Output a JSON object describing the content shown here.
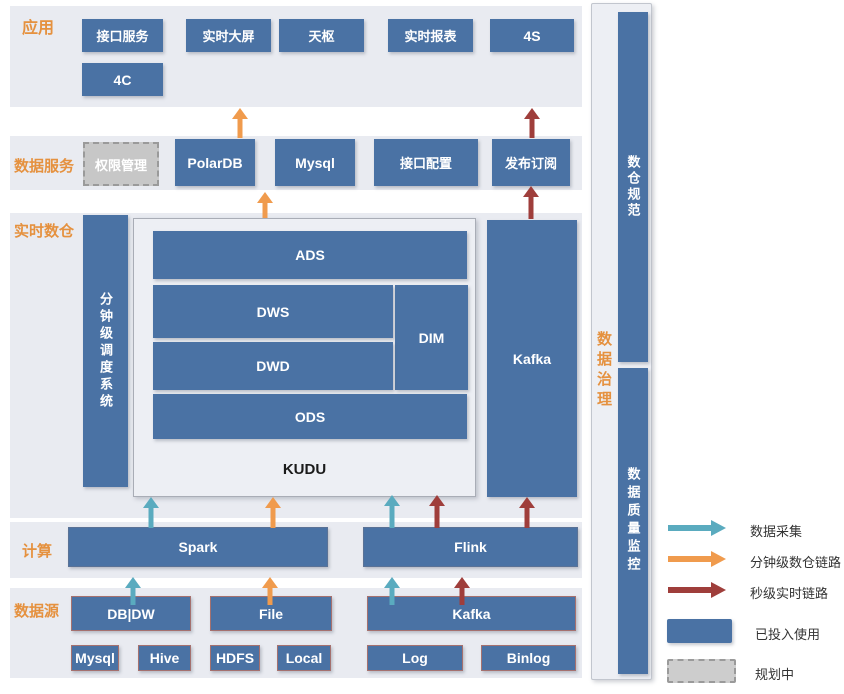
{
  "colors": {
    "box_blue": "#4a72a4",
    "section_bg": "#e9ebf1",
    "section_label_orange": "#e5913f",
    "arrow_teal": "#5aabbf",
    "arrow_orange": "#f09b4d",
    "arrow_red": "#9f3e3b",
    "planned_gray": "#c7c7c7"
  },
  "sections": {
    "app": {
      "label": "应用",
      "boxes": [
        "接口服务",
        "实时大屏",
        "天枢",
        "实时报表",
        "4S",
        "4C"
      ]
    },
    "services": {
      "label": "数据服务",
      "planned_box": "权限管理",
      "boxes": [
        "PolarDB",
        "Mysql",
        "接口配置",
        "发布订阅"
      ]
    },
    "warehouse": {
      "label": "实时数仓",
      "scheduler": "分钟级调度系统",
      "layers": {
        "ads": "ADS",
        "dws": "DWS",
        "dim": "DIM",
        "dwd": "DWD",
        "ods": "ODS"
      },
      "storage": "KUDU",
      "kafka": "Kafka"
    },
    "compute": {
      "label": "计算",
      "boxes": [
        "Spark",
        "Flink"
      ]
    },
    "sources": {
      "label": "数据源",
      "groups": [
        "DB|DW",
        "File",
        "Kafka"
      ],
      "items": [
        "Mysql",
        "Hive",
        "HDFS",
        "Local",
        "Log",
        "Binlog"
      ]
    },
    "governance": {
      "label": "数据治理",
      "boxes": [
        "数仓规范",
        "数据质量监控"
      ]
    }
  },
  "flows": [
    {
      "type": "minute-level",
      "from": "PolarDB",
      "to": "应用"
    },
    {
      "type": "second-level",
      "from": "发布订阅",
      "to": "应用"
    },
    {
      "type": "minute-level",
      "from": "实时数仓",
      "to": "数据服务"
    },
    {
      "type": "second-level",
      "from": "Kafka",
      "to": "发布订阅"
    },
    {
      "type": "collect",
      "from": "Spark",
      "to": "KUDU"
    },
    {
      "type": "minute-level",
      "from": "Spark",
      "to": "KUDU"
    },
    {
      "type": "collect",
      "from": "Flink",
      "to": "KUDU"
    },
    {
      "type": "second-level",
      "from": "Flink",
      "to": "KUDU"
    },
    {
      "type": "second-level",
      "from": "Flink",
      "to": "Kafka"
    },
    {
      "type": "collect",
      "from": "DB|DW",
      "to": "Spark"
    },
    {
      "type": "minute-level",
      "from": "File",
      "to": "Spark"
    },
    {
      "type": "collect",
      "from": "Kafka",
      "to": "Flink"
    },
    {
      "type": "second-level",
      "from": "Kafka",
      "to": "Flink"
    }
  ],
  "legend": {
    "arrows": [
      {
        "label": "数据采集",
        "color": "#5aabbf"
      },
      {
        "label": "分钟级数仓链路",
        "color": "#f09b4d"
      },
      {
        "label": "秒级实时链路",
        "color": "#9f3e3b"
      }
    ],
    "swatches": [
      {
        "label": "已投入使用",
        "style": "solid"
      },
      {
        "label": "规划中",
        "style": "dashed"
      }
    ]
  }
}
